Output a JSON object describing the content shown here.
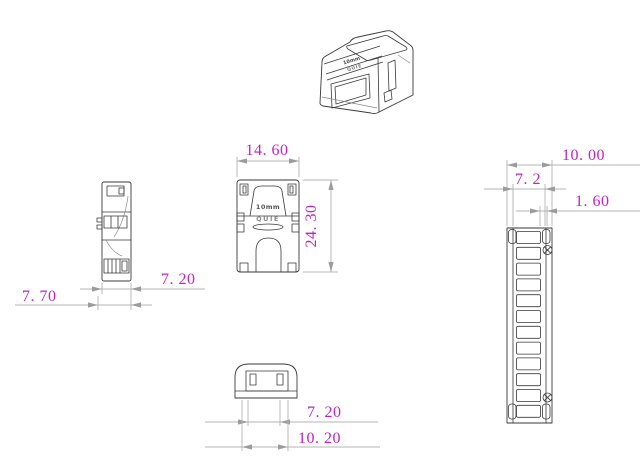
{
  "drawing": {
    "kind": "technical-dimension-drawing",
    "views": [
      "perspective",
      "side",
      "front",
      "bottom",
      "strip"
    ]
  },
  "dimensions": {
    "front_width": "14. 60",
    "front_height": "24. 30",
    "side_body_depth": "7. 20",
    "side_total_depth": "7. 70",
    "bottom_inner_width": "7. 20",
    "bottom_outer_width": "10. 20",
    "strip_outer_width": "10. 00",
    "strip_inner_width": "7. 2",
    "strip_rail_width": "1. 60"
  },
  "part_labels": {
    "size_marking": "10mm",
    "brand_marking": "QUIE"
  },
  "strip": {
    "pad_count": 12,
    "screw_count": 2
  },
  "colors": {
    "dimension_text": "#c520c5",
    "part_line": "#3a3a3a",
    "dimension_line": "#b4b4b4",
    "arrow": "#9c9c9c",
    "background": "#ffffff"
  }
}
